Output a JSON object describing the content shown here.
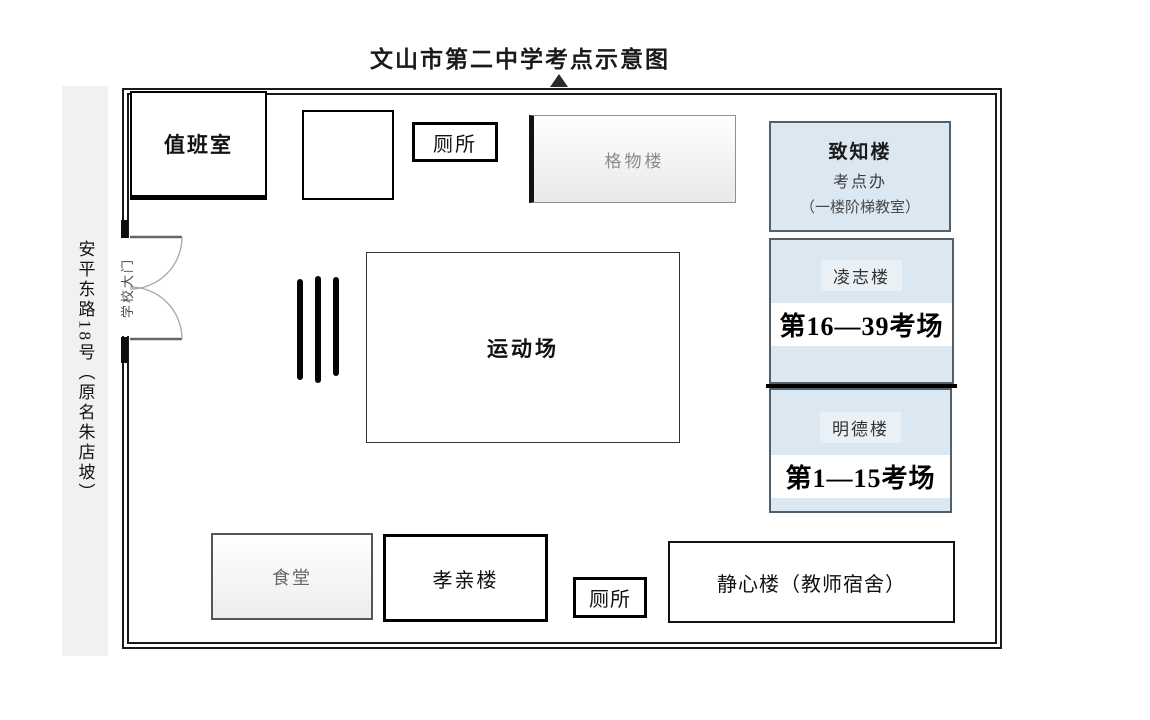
{
  "title": "文山市第二中学考点示意图",
  "street": {
    "label": "安平东路18号（原名朱店坡）"
  },
  "gate": {
    "label": "学校大门"
  },
  "buildings": {
    "duty_room": {
      "label": "值班室"
    },
    "toilet_top": {
      "label": "厕所"
    },
    "gewu": {
      "label": "格物楼"
    },
    "zhizhi": {
      "name": "致知楼",
      "subtitle": "考点办",
      "note": "（一楼阶梯教室）"
    },
    "lingzhi": {
      "name": "凌志楼",
      "rooms": "第16—39考场"
    },
    "mingde": {
      "name": "明德楼",
      "rooms": "第1—15考场"
    },
    "sports_field": {
      "label": "运动场"
    },
    "canteen": {
      "label": "食堂"
    },
    "xiaoqin": {
      "label": "孝亲楼"
    },
    "toilet_bottom": {
      "label": "厕所"
    },
    "jingxin": {
      "label": "静心楼（教师宿舍）"
    }
  },
  "colors": {
    "building_fill": "#dce8f1",
    "building_border": "#52606b",
    "street_strip": "#f1f1f1",
    "wall": "#1a1a1a"
  }
}
